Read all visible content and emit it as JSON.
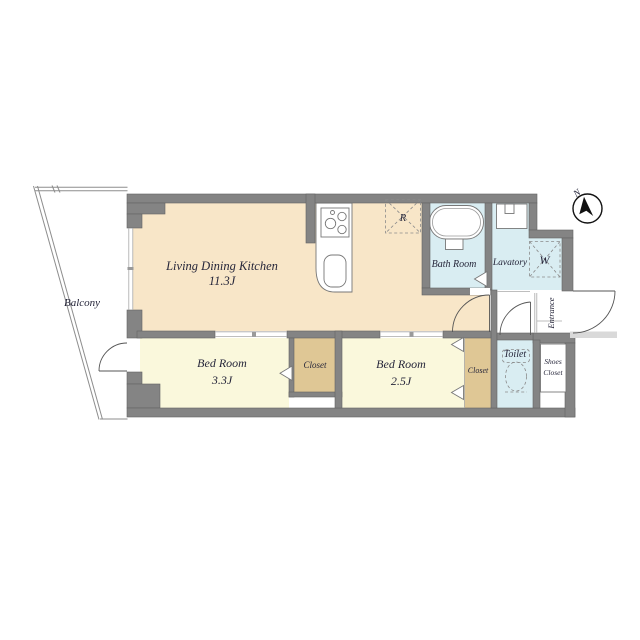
{
  "plan": {
    "balcony": {
      "label": "Balcony"
    },
    "ldk": {
      "label": "Living Dining Kitchen",
      "size": "11.3J"
    },
    "bedroom1": {
      "label": "Bed Room",
      "size": "3.3J"
    },
    "bedroom2": {
      "label": "Bed Room",
      "size": "2.5J"
    },
    "closet1": {
      "label": "Closet"
    },
    "closet2": {
      "label": "Closet"
    },
    "bathroom": {
      "label": "Bath Room"
    },
    "lavatory": {
      "label": "Lavatory"
    },
    "toilet": {
      "label": "Toilet"
    },
    "entrance": {
      "label": "Entrance"
    },
    "shoes_closet": {
      "line1": "Shoes",
      "line2": "Closet"
    },
    "appliance_marks": {
      "refrigerator": "R",
      "washing_machine": "W"
    },
    "compass": {
      "north_label": "N"
    },
    "colors": {
      "wall": "#848484",
      "ldk_floor": "#F8E6C8",
      "bedroom_floor": "#FAF8DC",
      "closet_floor": "#DFC795",
      "wet_area_floor": "#D9EDF2",
      "label_text": "#26263A"
    }
  }
}
